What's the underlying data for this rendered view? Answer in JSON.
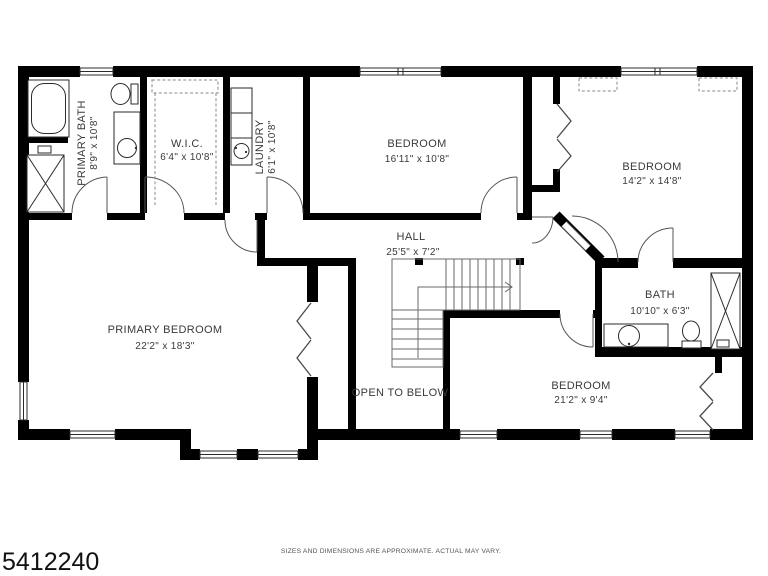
{
  "plan": {
    "id": "5412240",
    "disclaimer": "SIZES AND DIMENSIONS ARE APPROXIMATE. ACTUAL MAY VARY.",
    "rooms": {
      "primary_bath": {
        "name": "PRIMARY BATH",
        "dims": "8'9\" x 10'8\""
      },
      "wic": {
        "name": "W.I.C.",
        "dims": "6'4\" x 10'8\""
      },
      "laundry": {
        "name": "LAUNDRY",
        "dims": "6'1\" x 10'8\""
      },
      "bedroom_1": {
        "name": "BEDROOM",
        "dims": "16'11\" x 10'8\""
      },
      "bedroom_2": {
        "name": "BEDROOM",
        "dims": "14'2\" x 14'8\""
      },
      "hall": {
        "name": "HALL",
        "dims": "25'5\" x 7'2\""
      },
      "primary_bedroom": {
        "name": "PRIMARY BEDROOM",
        "dims": "22'2\" x 18'3\""
      },
      "bath": {
        "name": "BATH",
        "dims": "10'10\" x 6'3\""
      },
      "bedroom_3": {
        "name": "BEDROOM",
        "dims": "21'2\" x 9'4\""
      },
      "open_to_below": {
        "name": "OPEN TO BELOW"
      }
    },
    "colors": {
      "wall": "#000000",
      "label": "#3a3a3a",
      "background": "#ffffff"
    }
  }
}
